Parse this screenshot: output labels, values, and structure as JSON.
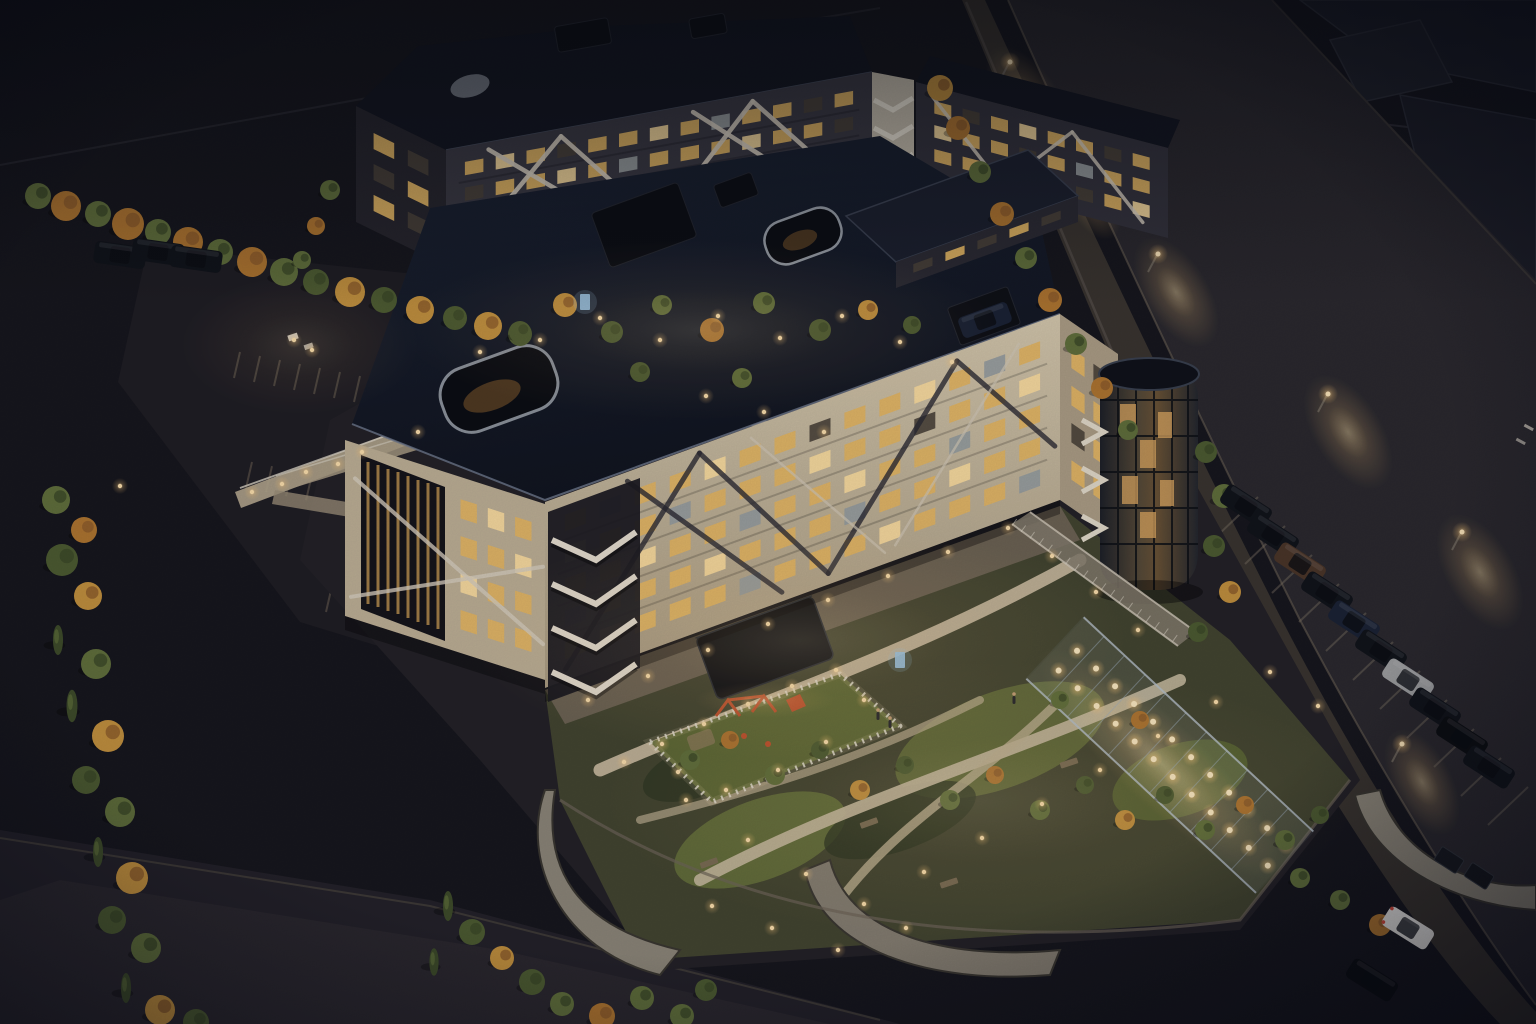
{
  "meta": {
    "description": "Aerial night-time architectural rendering of a residential complex with two apartment blocks, lit courtyards, playground, green roof garden, pergola walkway, parking lots and a street with parked cars",
    "width": 1536,
    "height": 1024
  },
  "palette": {
    "ground": "#16161b",
    "road": "#2a282c",
    "sidewalk": "#39342e",
    "curb": "#6b6053",
    "roofA": "#141a26",
    "roofB": "#12151e",
    "facadeLit": "#cbbda2",
    "facadeLeft": "#c0b296",
    "facadeEnd": "#ae9f85",
    "facadeDarkB": "#3a3942",
    "towerWhite": "#c9c0ae",
    "winWarm": "#e8b963",
    "winBright": "#ffe0a0",
    "winDim": "#4a4337",
    "winCool": "#9aa0a0",
    "braceWhite": "#dbd2c1",
    "braceDark": "#2b2a31",
    "braceLight": "#d6ccb8",
    "grassDark": "#323a22",
    "grassLit": "#5f6a34",
    "lawnBright": "#6c763c",
    "path": "#c9bb9e",
    "fence": "#e8e2d2",
    "concreteWall": "#8d8678",
    "wallShadow": "#39362f",
    "treeGreen": "#4d5c30",
    "treeGreen2": "#61703a",
    "treeAutumn": "#b0762f",
    "treeAutumn2": "#c4913d",
    "cypress": "#3e4c28",
    "glow": "#ffd99b",
    "accentRed": "#c2512c",
    "accentBlue": "#9cc8e8",
    "signalGreen": "#7fd89a",
    "carDark": "#101318",
    "carWhite": "#e9e7e2",
    "carBrown": "#4a3526",
    "carSilver": "#9fa0a0",
    "carNavy": "#1a2233",
    "carBlack": "#0b0d10"
  },
  "facades": [
    {
      "name": "building-b-left-facade",
      "layer": "b",
      "p": [
        356,
        106
      ],
      "u": [
        90,
        44
      ],
      "v": [
        0,
        116
      ],
      "rows": 3,
      "cols": 2,
      "padS": 0.12,
      "padT": 0.1,
      "patterns": [
        "WD",
        "DW",
        "WD"
      ],
      "floor_lines": false,
      "braces": []
    },
    {
      "name": "building-b-front-facade",
      "layer": "b",
      "p": [
        446,
        150
      ],
      "u": [
        426,
        -78
      ],
      "v": [
        0,
        122
      ],
      "rows": 4,
      "cols": 13,
      "padS": 0.03,
      "padT": 0.08,
      "patterns": [
        "WBWDWWBWCWWDW",
        "DWWBWCWWWBWWD",
        "WWDWWBWWDWWBW",
        "BWWWCWWDWWWDW"
      ],
      "floor_lines": true,
      "braces": [
        [
          0.03,
          0.92,
          0.27,
          0.06
        ],
        [
          0.27,
          0.06,
          0.5,
          0.92
        ],
        [
          0.5,
          0.92,
          0.72,
          0.06
        ],
        [
          0.72,
          0.06,
          0.95,
          0.92
        ],
        [
          0.1,
          0.06,
          0.42,
          0.92
        ],
        [
          0.58,
          0.06,
          0.88,
          0.92
        ]
      ],
      "brace_color": "braceWhite",
      "brace_w": 4.5,
      "brace_op": 0.92
    },
    {
      "name": "building-b-right-wing-facade",
      "layer": "b",
      "p": [
        916,
        82
      ],
      "u": [
        252,
        66
      ],
      "v": [
        0,
        90
      ],
      "rows": 3,
      "cols": 8,
      "padS": 0.05,
      "padT": 0.1,
      "patterns": [
        "WDWBWWDW",
        "BWWDWCWW",
        "WWBWWDWB"
      ],
      "floor_lines": false,
      "braces": [
        [
          0.06,
          0.1,
          0.34,
          0.9
        ],
        [
          0.34,
          0.9,
          0.62,
          0.1
        ],
        [
          0.62,
          0.1,
          0.9,
          0.9
        ]
      ],
      "brace_color": "braceWhite",
      "brace_w": 3.5,
      "brace_op": 0.85
    },
    {
      "name": "building-a-left-facade",
      "layer": "a",
      "p": [
        345,
        440
      ],
      "u": [
        200,
        64
      ],
      "v": [
        0,
        176
      ],
      "rows": 4,
      "cols": 3,
      "padS": 0.55,
      "padS2": 0.04,
      "padT": 0.08,
      "patterns": [
        "WBW",
        "WWB",
        "BWW",
        "WWW"
      ],
      "floor_lines": false,
      "braces": [
        [
          0.03,
          0.88,
          0.99,
          0.36
        ],
        [
          0.05,
          0.2,
          0.99,
          0.8
        ]
      ],
      "brace_color": "braceWhite",
      "brace_w": 4,
      "brace_op": 0.8
    },
    {
      "name": "building-a-front-facade",
      "layer": "a",
      "p": [
        545,
        502
      ],
      "u": [
        515,
        -188
      ],
      "v": [
        0,
        186
      ],
      "rows": 5,
      "cols": 14,
      "padS": 0.025,
      "padT": 0.07,
      "patterns": [
        "WCWWBWWDWWBWCW",
        "BWWCWWWBWWDWWB",
        "WWBWWCWWBWWCWW",
        "CWWWBWWWCWWBWW",
        "WBWWWCWWWBWWWC"
      ],
      "floor_lines": true,
      "braces": [
        [
          0.04,
          0.94,
          0.3,
          0.04
        ],
        [
          0.3,
          0.04,
          0.55,
          0.94
        ],
        [
          0.55,
          0.94,
          0.8,
          0.05
        ],
        [
          0.8,
          0.05,
          0.99,
          0.7
        ],
        [
          0.16,
          0.05,
          0.46,
          0.95
        ]
      ],
      "brace_color": "braceDark",
      "brace_w": 5,
      "brace_op": 0.8,
      "brace2": [
        [
          0.4,
          0.06,
          0.66,
          0.94
        ],
        [
          0.68,
          0.92,
          0.92,
          0.08
        ]
      ],
      "brace2_color": "braceLight",
      "brace2_w": 2.5,
      "brace2_op": 0.7
    },
    {
      "name": "building-a-end-facade",
      "layer": "a",
      "p": [
        1060,
        314
      ],
      "u": [
        58,
        40
      ],
      "v": [
        0,
        186
      ],
      "rows": 4,
      "cols": 2,
      "padS": 0.12,
      "padT": 0.1,
      "patterns": [
        "WD",
        "WW",
        "DW",
        "WW"
      ],
      "floor_lines": false,
      "braces": []
    },
    {
      "name": "building-a-penthouse-facade",
      "layer": "a",
      "p": [
        896,
        262
      ],
      "u": [
        182,
        -66
      ],
      "v": [
        0,
        26
      ],
      "rows": 1,
      "cols": 5,
      "padS": 0.06,
      "padT": 0.18,
      "patterns": [
        "DWDWD"
      ],
      "floor_lines": false,
      "braces": []
    }
  ],
  "trees": [
    [
      62,
      560,
      16,
      "g"
    ],
    [
      88,
      596,
      14,
      "a"
    ],
    [
      58,
      640,
      12,
      "c"
    ],
    [
      96,
      664,
      15,
      "g"
    ],
    [
      72,
      706,
      13,
      "c"
    ],
    [
      108,
      736,
      16,
      "a"
    ],
    [
      86,
      780,
      14,
      "g"
    ],
    [
      120,
      812,
      15,
      "g"
    ],
    [
      98,
      852,
      12,
      "c"
    ],
    [
      132,
      878,
      16,
      "a"
    ],
    [
      112,
      920,
      14,
      "g"
    ],
    [
      146,
      948,
      15,
      "g"
    ],
    [
      126,
      988,
      12,
      "c"
    ],
    [
      160,
      1010,
      15,
      "a"
    ],
    [
      196,
      1022,
      13,
      "g"
    ],
    [
      56,
      500,
      14,
      "g"
    ],
    [
      84,
      530,
      13,
      "a"
    ],
    [
      38,
      196,
      13,
      "g"
    ],
    [
      66,
      206,
      15,
      "a"
    ],
    [
      98,
      214,
      13,
      "g"
    ],
    [
      128,
      224,
      16,
      "a"
    ],
    [
      158,
      232,
      13,
      "g"
    ],
    [
      188,
      242,
      15,
      "a"
    ],
    [
      220,
      252,
      13,
      "g"
    ],
    [
      252,
      262,
      15,
      "a"
    ],
    [
      284,
      272,
      14,
      "g"
    ],
    [
      316,
      282,
      13,
      "g"
    ],
    [
      350,
      292,
      15,
      "a"
    ],
    [
      384,
      300,
      13,
      "g"
    ],
    [
      420,
      310,
      14,
      "a"
    ],
    [
      455,
      318,
      12,
      "g"
    ],
    [
      488,
      326,
      14,
      "a"
    ],
    [
      520,
      334,
      12,
      "g"
    ],
    [
      330,
      190,
      10,
      "g"
    ],
    [
      316,
      226,
      9,
      "a"
    ],
    [
      302,
      260,
      9,
      "g"
    ],
    [
      520,
      332,
      11,
      "g"
    ],
    [
      565,
      305,
      12,
      "a"
    ],
    [
      612,
      332,
      11,
      "g"
    ],
    [
      662,
      305,
      10,
      "g"
    ],
    [
      712,
      330,
      12,
      "a"
    ],
    [
      764,
      303,
      11,
      "g"
    ],
    [
      820,
      330,
      11,
      "g"
    ],
    [
      868,
      310,
      10,
      "a"
    ],
    [
      640,
      372,
      10,
      "g"
    ],
    [
      742,
      378,
      10,
      "g"
    ],
    [
      912,
      325,
      9,
      "g"
    ],
    [
      940,
      88,
      13,
      "a"
    ],
    [
      958,
      128,
      12,
      "a"
    ],
    [
      980,
      172,
      11,
      "g"
    ],
    [
      1002,
      214,
      12,
      "a"
    ],
    [
      1026,
      258,
      11,
      "g"
    ],
    [
      1050,
      300,
      12,
      "a"
    ],
    [
      1076,
      344,
      11,
      "g"
    ],
    [
      1102,
      388,
      11,
      "a"
    ],
    [
      1128,
      430,
      10,
      "g"
    ],
    [
      1206,
      452,
      11,
      "g"
    ],
    [
      1224,
      496,
      12,
      "g"
    ],
    [
      1214,
      546,
      11,
      "g"
    ],
    [
      1230,
      592,
      11,
      "a"
    ],
    [
      1198,
      632,
      10,
      "g"
    ],
    [
      690,
      760,
      10,
      "g"
    ],
    [
      730,
      740,
      9,
      "a"
    ],
    [
      775,
      775,
      10,
      "g"
    ],
    [
      820,
      750,
      9,
      "g"
    ],
    [
      860,
      790,
      10,
      "a"
    ],
    [
      905,
      765,
      9,
      "g"
    ],
    [
      950,
      800,
      10,
      "g"
    ],
    [
      995,
      775,
      9,
      "a"
    ],
    [
      1040,
      810,
      10,
      "g"
    ],
    [
      1085,
      785,
      9,
      "g"
    ],
    [
      1125,
      820,
      10,
      "a"
    ],
    [
      1165,
      795,
      9,
      "g"
    ],
    [
      1205,
      830,
      10,
      "g"
    ],
    [
      1245,
      805,
      9,
      "a"
    ],
    [
      1285,
      840,
      10,
      "g"
    ],
    [
      1320,
      815,
      9,
      "g"
    ],
    [
      1060,
      700,
      9,
      "g"
    ],
    [
      1140,
      720,
      9,
      "a"
    ],
    [
      448,
      906,
      12,
      "c"
    ],
    [
      472,
      932,
      13,
      "g"
    ],
    [
      502,
      958,
      12,
      "a"
    ],
    [
      532,
      982,
      13,
      "g"
    ],
    [
      562,
      1004,
      12,
      "g"
    ],
    [
      602,
      1016,
      13,
      "a"
    ],
    [
      642,
      998,
      12,
      "g"
    ],
    [
      434,
      962,
      11,
      "c"
    ],
    [
      682,
      1016,
      12,
      "g"
    ],
    [
      706,
      990,
      11,
      "g"
    ],
    [
      1340,
      900,
      10,
      "g"
    ],
    [
      1380,
      925,
      11,
      "a"
    ],
    [
      1300,
      878,
      10,
      "g"
    ]
  ],
  "path_lights": [
    [
      480,
      352
    ],
    [
      540,
      340
    ],
    [
      600,
      318
    ],
    [
      660,
      340
    ],
    [
      718,
      316
    ],
    [
      780,
      338
    ],
    [
      842,
      316
    ],
    [
      900,
      342
    ],
    [
      952,
      362
    ],
    [
      706,
      396
    ],
    [
      764,
      412
    ],
    [
      824,
      432
    ],
    [
      252,
      492
    ],
    [
      306,
      472
    ],
    [
      362,
      452
    ],
    [
      418,
      432
    ],
    [
      282,
      484
    ],
    [
      338,
      464
    ],
    [
      588,
      700
    ],
    [
      648,
      676
    ],
    [
      708,
      650
    ],
    [
      768,
      624
    ],
    [
      828,
      600
    ],
    [
      888,
      576
    ],
    [
      948,
      552
    ],
    [
      1008,
      528
    ],
    [
      1052,
      556
    ],
    [
      1096,
      592
    ],
    [
      1138,
      630
    ],
    [
      624,
      762
    ],
    [
      686,
      800
    ],
    [
      748,
      840
    ],
    [
      806,
      874
    ],
    [
      864,
      904
    ],
    [
      924,
      872
    ],
    [
      982,
      838
    ],
    [
      1042,
      804
    ],
    [
      1100,
      770
    ],
    [
      1158,
      736
    ],
    [
      1216,
      702
    ],
    [
      712,
      906
    ],
    [
      772,
      928
    ],
    [
      838,
      950
    ],
    [
      906,
      928
    ],
    [
      1270,
      672
    ],
    [
      1318,
      706
    ],
    [
      662,
      744
    ],
    [
      704,
      724
    ],
    [
      748,
      704
    ],
    [
      792,
      686
    ],
    [
      836,
      670
    ],
    [
      864,
      700
    ],
    [
      826,
      742
    ],
    [
      778,
      770
    ],
    [
      726,
      790
    ],
    [
      678,
      772
    ],
    [
      294,
      340
    ],
    [
      312,
      350
    ],
    [
      120,
      486
    ]
  ],
  "street": {
    "pools": [
      [
        1028,
        98,
        60,
        30,
        55
      ],
      [
        1092,
        204,
        40,
        22,
        57
      ],
      [
        1176,
        292,
        62,
        32,
        58
      ],
      [
        1348,
        432,
        64,
        34,
        58
      ],
      [
        1480,
        572,
        64,
        34,
        60
      ],
      [
        1422,
        782,
        58,
        30,
        62
      ]
    ],
    "lamps": [
      [
        1000,
        80
      ],
      [
        1148,
        272
      ],
      [
        1318,
        412
      ],
      [
        1452,
        550
      ],
      [
        1392,
        762
      ]
    ],
    "bay_lines": {
      "start": [
        1238,
        516
      ],
      "step": [
        27,
        29
      ],
      "count": 11
    },
    "signal": [
      1016,
      196
    ]
  },
  "cars": {
    "street_row": {
      "start": [
        1246,
        506
      ],
      "step": [
        27,
        29
      ],
      "rot": 33,
      "colors": [
        "carDark",
        "carDark",
        "carBrown",
        "carDark",
        "carNavy",
        "carDark",
        "carSilver",
        "carDark",
        "carBlack",
        "carDark"
      ]
    },
    "extra": [
      {
        "x": 1408,
        "y": 928,
        "rot": 32,
        "color": "carWhite",
        "tail": true
      },
      {
        "x": 1372,
        "y": 980,
        "rot": 32,
        "color": "carBlack"
      },
      {
        "x": 120,
        "y": 255,
        "rot": 8,
        "color": "carDark"
      },
      {
        "x": 158,
        "y": 252,
        "rot": 8,
        "color": "carDark"
      },
      {
        "x": 196,
        "y": 259,
        "rot": 8,
        "color": "carDark"
      },
      {
        "x": 985,
        "y": 320,
        "rot": -20,
        "color": "carNavy"
      }
    ]
  },
  "stall_rows": [
    {
      "from": [
        240,
        352
      ],
      "to": [
        560,
        416
      ],
      "n": 17,
      "dir": [
        -6,
        26
      ]
    },
    {
      "from": [
        252,
        462
      ],
      "to": [
        612,
        536
      ],
      "n": 19,
      "dir": [
        -6,
        26
      ]
    },
    {
      "from": [
        332,
        586
      ],
      "to": [
        632,
        642
      ],
      "n": 16,
      "dir": [
        -6,
        26
      ]
    }
  ],
  "pergola": {
    "lights_x": [
      18,
      44,
      70,
      96,
      122,
      148,
      174,
      200,
      226,
      252,
      278,
      304
    ],
    "rows_y": [
      -13,
      14
    ]
  },
  "people": [
    [
      878,
      716
    ],
    [
      890,
      724
    ],
    [
      1014,
      700
    ]
  ],
  "info_boards": [
    [
      585,
      302
    ],
    [
      900,
      660
    ]
  ],
  "washes": [
    [
      700,
      330,
      300,
      90,
      0.18
    ],
    [
      800,
      640,
      330,
      120,
      0.22
    ],
    [
      980,
      800,
      380,
      140,
      0.16
    ],
    [
      300,
      345,
      120,
      70,
      0.14
    ]
  ]
}
